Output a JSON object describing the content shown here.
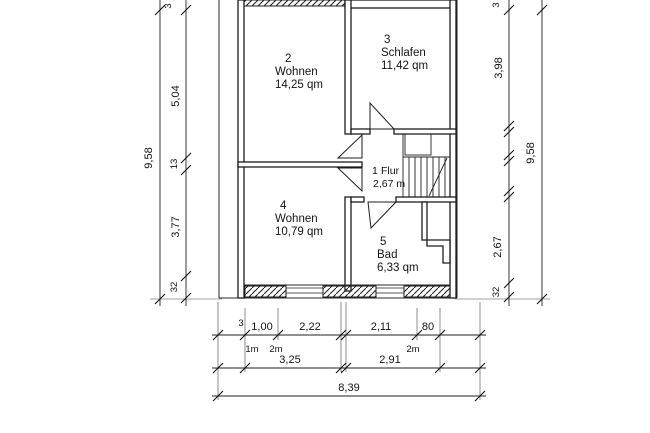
{
  "drawing_type": "floor-plan",
  "rooms": [
    {
      "number": "2",
      "name": "Wohnen",
      "area": "14,25 qm"
    },
    {
      "number": "3",
      "name": "Schlafen",
      "area": "11,42 qm"
    },
    {
      "number": "1",
      "name": "Flur",
      "area": "2,67 m"
    },
    {
      "number": "4",
      "name": "Wohnen",
      "area": "10,79 qm"
    },
    {
      "number": "5",
      "name": "Bad",
      "area": "6,33 qm"
    }
  ],
  "dimensions": {
    "left": {
      "total": "9,58",
      "segments": [
        "3",
        "5,04",
        "13",
        "3,77",
        "32"
      ]
    },
    "right": {
      "total": "9,58",
      "segments": [
        "3",
        "3,98",
        "2,67",
        "32"
      ]
    },
    "bottom": {
      "row1": [
        "3",
        "1,00",
        "2,22",
        "2,11",
        "80"
      ],
      "heights": [
        "1m",
        "2m",
        "2m"
      ],
      "row2": [
        "3,25",
        "2,91"
      ],
      "total": "8,39"
    }
  },
  "colors": {
    "ink": "#1c1c1c",
    "paper": "#ffffff"
  }
}
